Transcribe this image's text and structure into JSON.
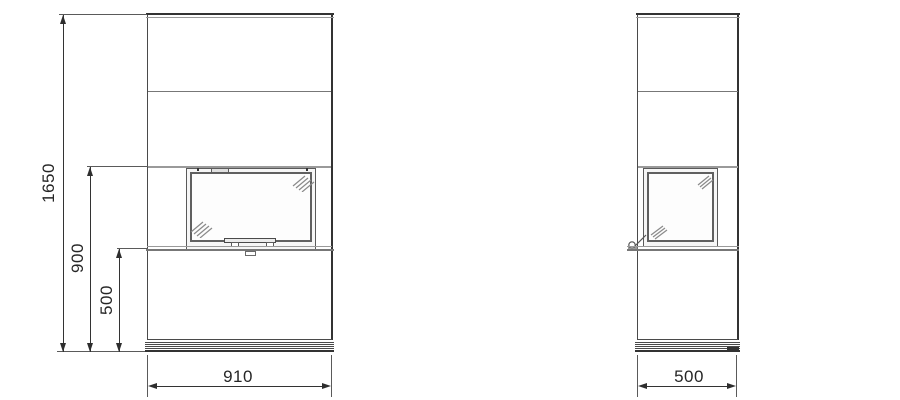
{
  "drawing": {
    "subject": "fireplace elevation drawing",
    "views": {
      "front": "front elevation",
      "side": "side elevation"
    }
  },
  "front_view": {
    "dims": {
      "total_height": "1650",
      "upper_height": "900",
      "lower_height": "500",
      "width": "910"
    }
  },
  "side_view": {
    "dims": {
      "depth": "500"
    }
  },
  "colors": {
    "background": "#ffffff",
    "line_dark": "#333333",
    "line_main": "#4a4a4a",
    "line_mid": "#777777",
    "line_light": "#9a9a9a",
    "text": "#262626"
  }
}
